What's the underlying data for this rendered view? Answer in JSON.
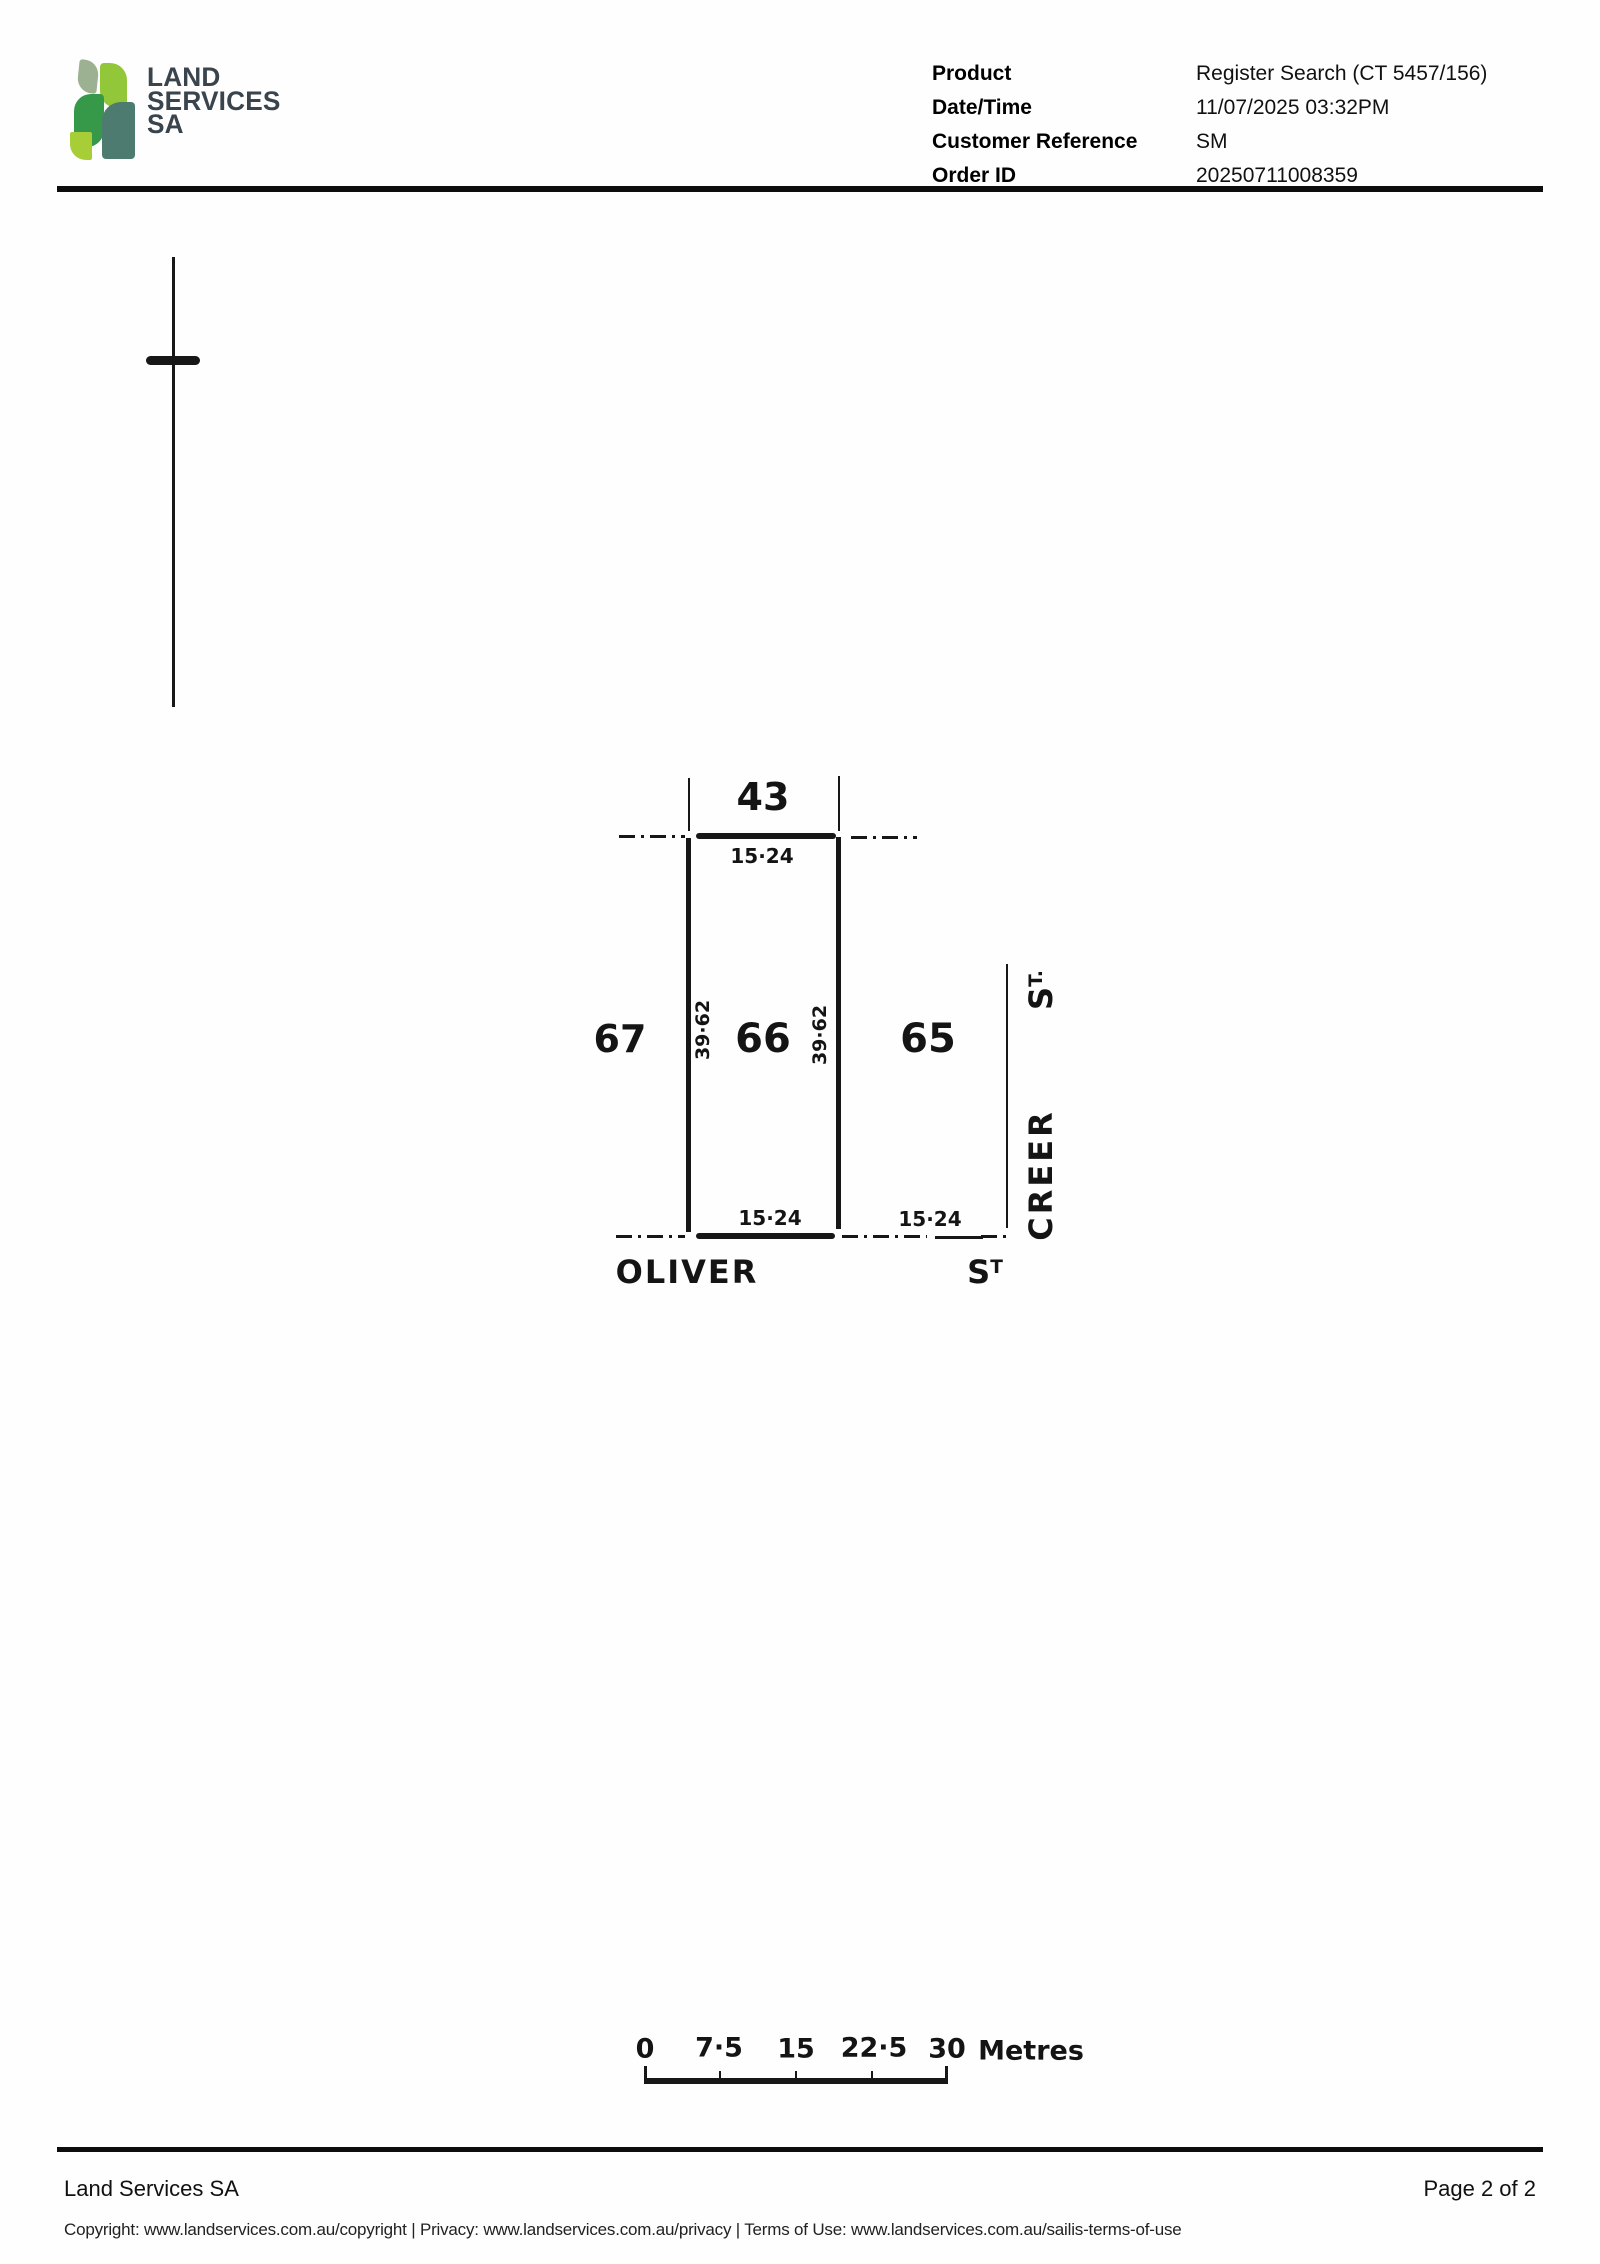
{
  "header": {
    "logo": {
      "line1": "LAND",
      "line2": "SERVICES",
      "line3": "SA"
    },
    "meta": {
      "rows": [
        {
          "label": "Product",
          "value": "Register Search (CT 5457/156)"
        },
        {
          "label": "Date/Time",
          "value": "11/07/2025 03:32PM"
        },
        {
          "label": "Customer Reference",
          "value": "SM"
        },
        {
          "label": "Order ID",
          "value": "20250711008359"
        }
      ]
    }
  },
  "plan": {
    "lots": {
      "top": "43",
      "left": "67",
      "center": "66",
      "right": "65"
    },
    "dimensions": {
      "top": "15·24",
      "west": "39·62",
      "east": "39·62",
      "bottom_west": "15·24",
      "bottom_east": "15·24"
    },
    "streets": {
      "oliver": {
        "name": "OLIVER",
        "suffix_main": "S",
        "suffix_sup": "T"
      },
      "creer": {
        "name": "CREER",
        "suffix_main": "S",
        "suffix_sup": "T."
      }
    },
    "scale": {
      "labels": [
        "0",
        "7·5",
        "15",
        "22·5",
        "30"
      ],
      "unit": "Metres"
    }
  },
  "footer": {
    "org": "Land Services SA",
    "page": "Page 2 of 2",
    "links": "Copyright: www.landservices.com.au/copyright | Privacy: www.landservices.com.au/privacy | Terms of Use: www.landservices.com.au/sailis-terms-of-use"
  },
  "colors": {
    "ink": "#171717",
    "brand_text": "#3a444d",
    "leaf_sage": "#9cb092",
    "leaf_lime": "#93c73a",
    "leaf_green": "#36994a",
    "leaf_teal": "#4e7b70",
    "leaf_bright": "#a7cd37"
  }
}
